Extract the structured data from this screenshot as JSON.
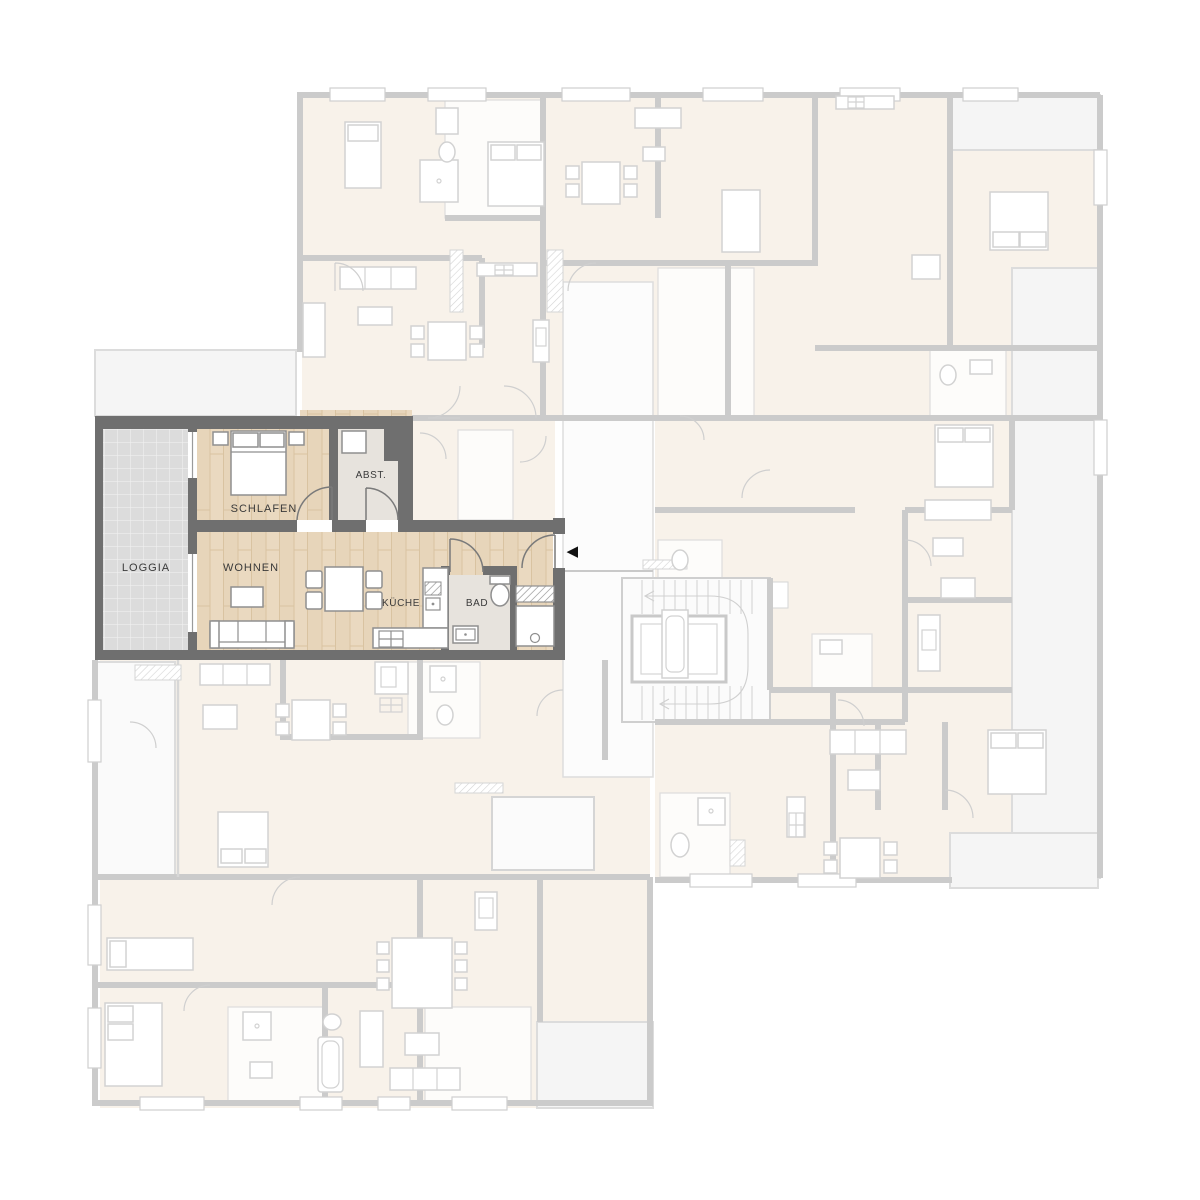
{
  "floorplan": {
    "type": "apartment-building-floor-plan",
    "unit_rooms": {
      "loggia": "LOGGIA",
      "schlafen": "SCHLAFEN",
      "abst": "ABST.",
      "wohnen": "WOHNEN",
      "kueche": "KÜCHE",
      "bad": "BAD"
    },
    "icons": {
      "entrance_arrow": "◀"
    },
    "colors": {
      "unit_wall": "#6f6f6f",
      "unit_floor_wood": "#e9d8bd",
      "unit_floor_utility": "#e7e3dd",
      "loggia_floor": "#dcdcdc",
      "faded_wall": "#cbcbcb",
      "faded_floor": "#f8f2ea",
      "terrace": "#f5f5f5",
      "entrance_marker": "#111111"
    }
  }
}
